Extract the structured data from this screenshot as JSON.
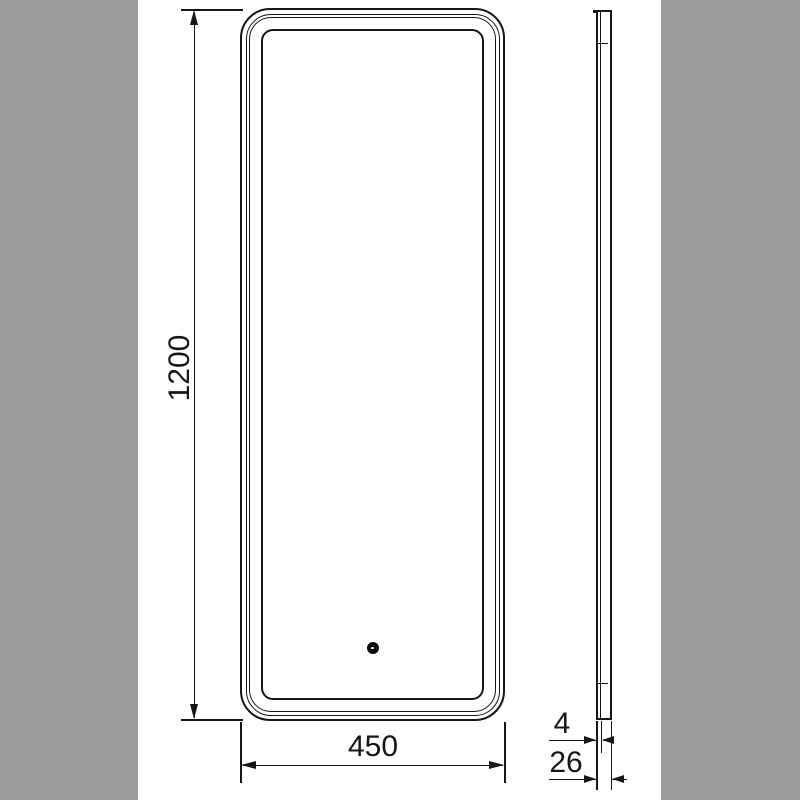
{
  "drawing": {
    "subject": "led-mirror-dimension-drawing",
    "front_view": {
      "height_label": "1200",
      "width_label": "450"
    },
    "side_view": {
      "glass_thickness_label": "4",
      "depth_label": "26"
    }
  },
  "colors": {
    "background": "#9b9b9b",
    "sheet": "#ffffff",
    "line": "#161616"
  }
}
